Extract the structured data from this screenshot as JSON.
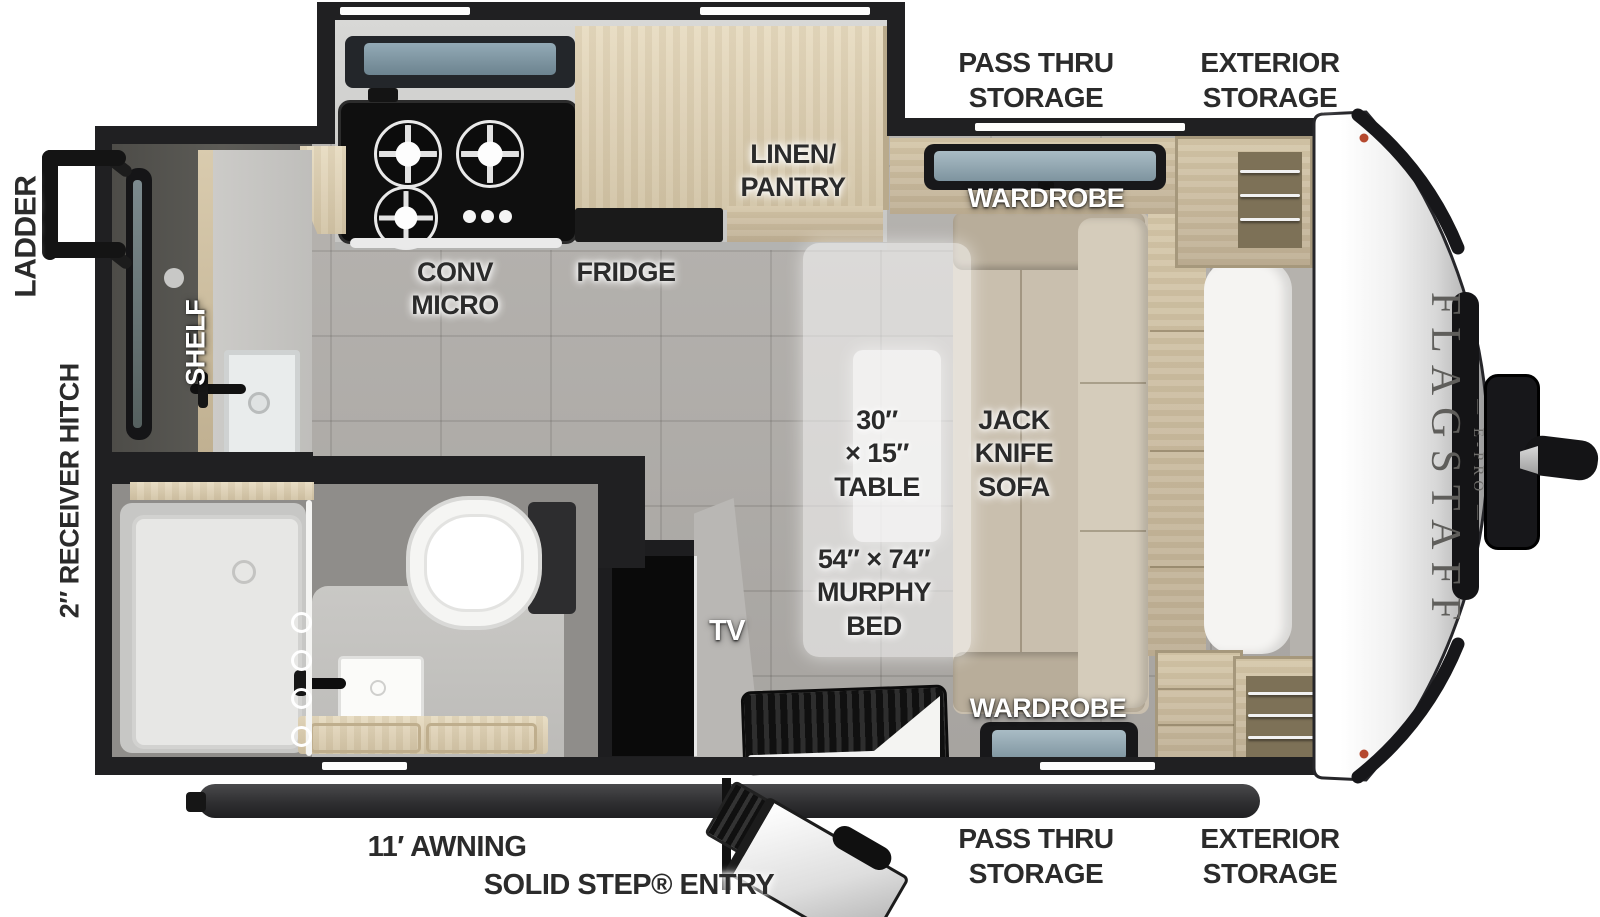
{
  "floorplan": {
    "brand": {
      "name": "FLAGSTAFF",
      "model": "E-PRO",
      "model_display": "— E-PRO —"
    },
    "exterior": {
      "ladder": "LADDER",
      "receiver_hitch": "2″ RECEIVER HITCH",
      "awning": "11′ AWNING",
      "solid_step_entry": "SOLID STEP® ENTRY",
      "pass_thru_storage_top": {
        "line1": "PASS THRU",
        "line2": "STORAGE"
      },
      "exterior_storage_top": {
        "line1": "EXTERIOR",
        "line2": "STORAGE"
      },
      "pass_thru_storage_bottom": {
        "line1": "PASS THRU",
        "line2": "STORAGE"
      },
      "exterior_storage_bottom": {
        "line1": "EXTERIOR",
        "line2": "STORAGE"
      }
    },
    "interior": {
      "shelf": "SHELF",
      "conv_micro": {
        "line1": "CONV",
        "line2": "MICRO"
      },
      "fridge": "FRIDGE",
      "linen_pantry": {
        "line1": "LINEN/",
        "line2": "PANTRY"
      },
      "wardrobe_top": "WARDROBE",
      "wardrobe_bottom": "WARDROBE",
      "table": {
        "line1": "30″",
        "line2": "× 15″",
        "line3": "TABLE"
      },
      "jack_knife_sofa": {
        "line1": "JACK",
        "line2": "KNIFE",
        "line3": "SOFA"
      },
      "murphy_bed": {
        "line1": "54″ × 74″",
        "line2": "MURPHY",
        "line3": "BED"
      },
      "tv": "TV"
    },
    "colors": {
      "wall": "#202022",
      "floor_tile": "#b1aeaa",
      "wood_light": "#e2d6bd",
      "wood_mid": "#cfc1a5",
      "sofa_beige": "#c9bfae",
      "window_glass": "#8fa3ad",
      "cap_trim": "#1b1b1d",
      "label_dark": "#2b2b2b"
    }
  }
}
